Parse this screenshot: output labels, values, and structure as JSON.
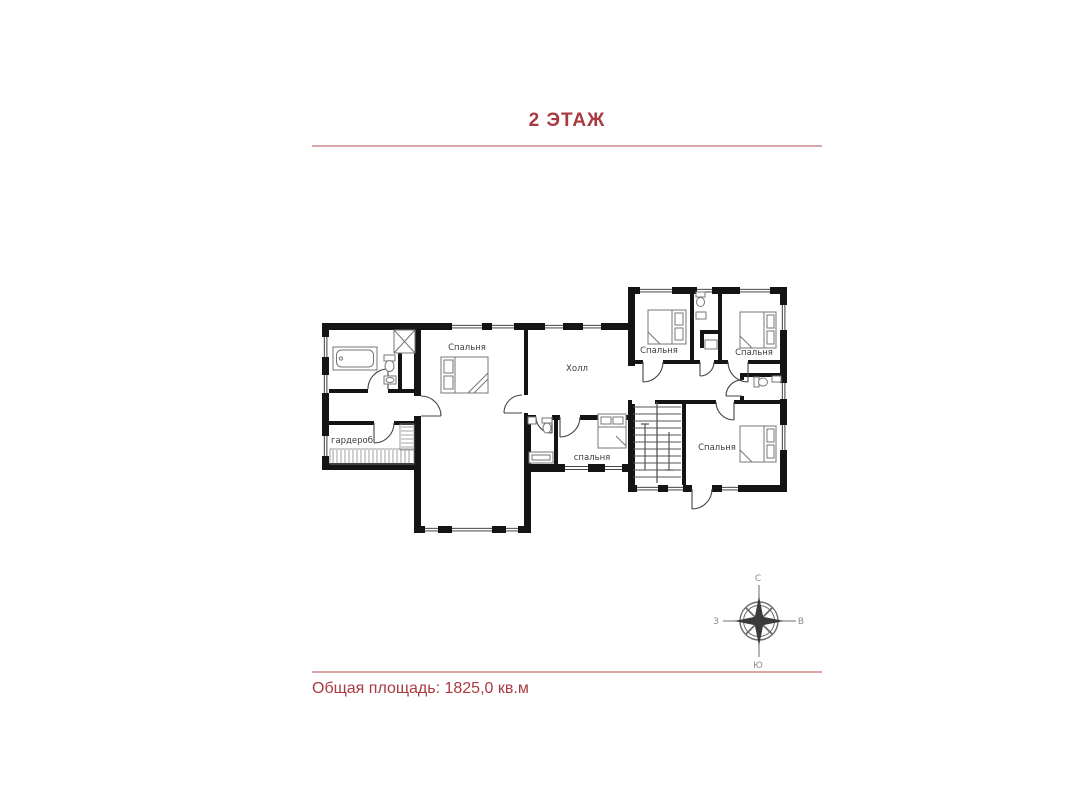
{
  "header": {
    "title": "2 ЭТАЖ"
  },
  "footer": {
    "total_area": "Общая площадь: 1825,0 кв.м"
  },
  "colors": {
    "accent": "#a93a40",
    "divider": "#d9a6a8",
    "wall": "#141414",
    "furniture": "#777777",
    "room_label": "#3d3d3d",
    "compass": "#6b6b6b"
  },
  "plan": {
    "rooms": {
      "bedroom_top": {
        "label": "Спальня"
      },
      "hall": {
        "label": "Холл"
      },
      "bedroom_ne_left": {
        "label": "Спальня"
      },
      "bedroom_ne_right": {
        "label": "Спальня"
      },
      "bedroom_se": {
        "label": "Спальня"
      },
      "bedroom_center_small": {
        "label": "спальня"
      },
      "wardrobe": {
        "label": "гардероб"
      }
    }
  },
  "compass": {
    "north": "С",
    "south": "Ю",
    "west": "З",
    "east": "В"
  }
}
